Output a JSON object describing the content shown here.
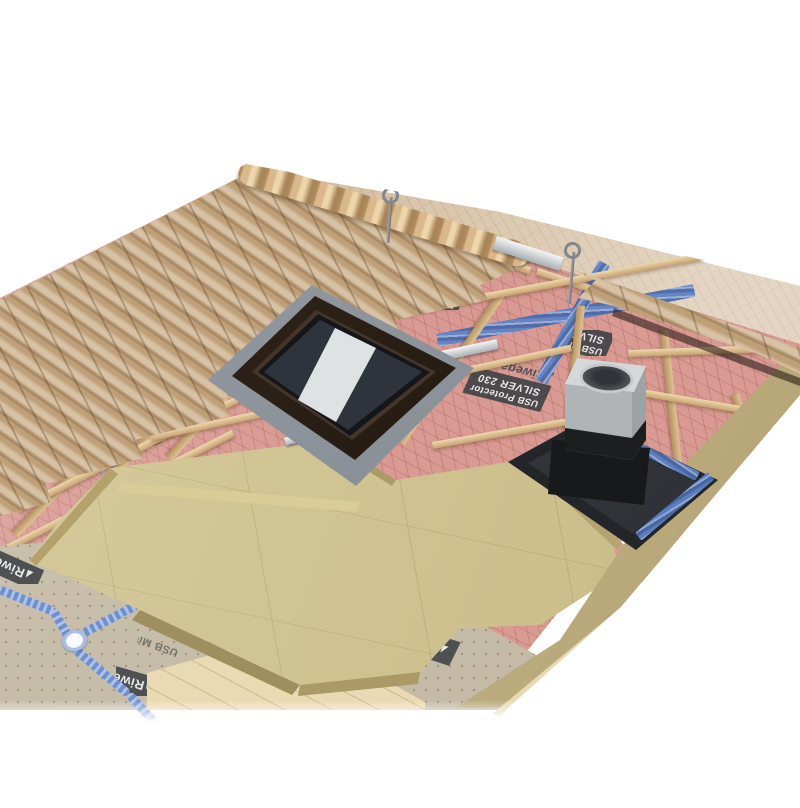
{
  "scene": {
    "membrane_protector": {
      "brand": "Riwega",
      "product_line1": "USB Protector",
      "product_line2": "SILVER 230",
      "color": "#d89a93"
    },
    "membrane_micro": {
      "brand": "Riwega",
      "product": "USB Micro Strong",
      "color": "#cac0ab"
    },
    "palette": {
      "bg": "#ffffff",
      "pink": "#d89a93",
      "pink-fold": "#e8b0a8",
      "tile": "#c9ab83",
      "back-slope": "#c9ac85",
      "batten": "#e2c89c",
      "insulation": "#cfc18b",
      "insulation-side": "#c0af7e",
      "beige": "#cac0ab",
      "deck": "#e9dab3",
      "tape": "#5f84c6",
      "cord": "#6e8fd0",
      "grommet": "#aabde2",
      "label-box": "#3e4246",
      "label-text": "#f0f0ee",
      "brand-gray": "#4d5156",
      "window-frame": "#241b12",
      "glass": "#343a42",
      "glass-shine": "#eff1f2",
      "flashing": "#99a0a7",
      "chimney-light": "#d5d8da",
      "chimney-mid": "#b7bbbe",
      "chimney-dark": "#9da2a5",
      "chimney-flashing": "#232629"
    }
  }
}
